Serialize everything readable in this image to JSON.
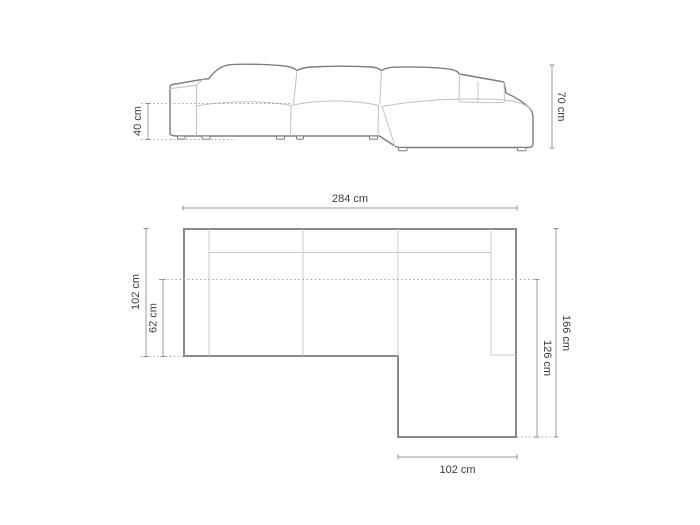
{
  "drawing": {
    "type": "sofa-technical-drawing",
    "views": [
      "side-elevation",
      "top-plan"
    ],
    "line_color": "#8a8a8a",
    "text_color": "#3d3d3d",
    "background": "#ffffff"
  },
  "labels": {
    "elevation_seat_height": "40 cm",
    "elevation_total_height": "70 cm",
    "plan_total_width": "284 cm",
    "plan_total_depth": "102 cm",
    "plan_seat_depth": "62 cm",
    "plan_right_depth": "166 cm",
    "plan_chaise_length": "126 cm",
    "plan_chaise_width": "102 cm"
  },
  "dimensions": {
    "side_view": {
      "seat_height_cm": 40,
      "total_height_cm": 70
    },
    "top_view": {
      "total_width_cm": 284,
      "total_depth_left_cm": 102,
      "seat_depth_cm": 62,
      "total_depth_right_cm": 166,
      "chaise_extension_cm": 126,
      "chaise_width_cm": 102
    }
  }
}
